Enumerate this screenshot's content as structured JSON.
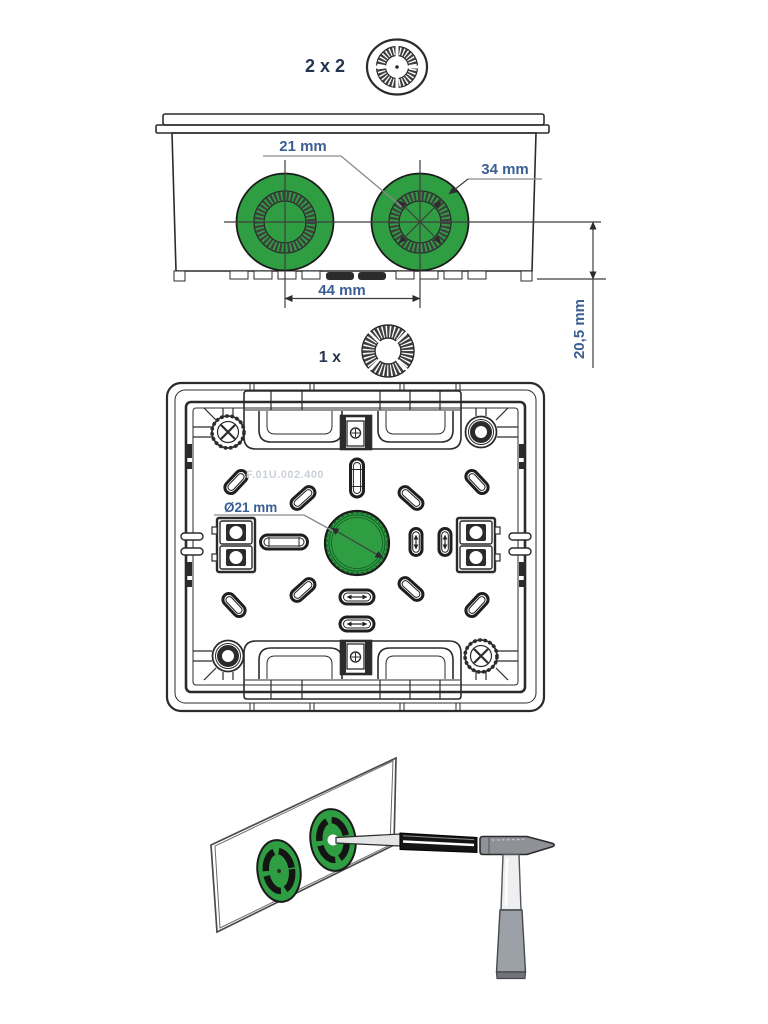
{
  "figure": {
    "colors": {
      "line": "#2b2b2b",
      "green": "#2f9e43",
      "green_dark": "#145c26",
      "dim_text": "#3a5f93",
      "qty_text": "#26354f",
      "dim_line": "#3f3f3f",
      "watermark": "#ccd1d9",
      "hammer_head": "#8e9195",
      "hammer_grip": "#9ba1a6",
      "handle_light": "#edeff0",
      "tool_dark": "#141414"
    },
    "icons": {
      "top_quantity_icon": "cable-grommet-icon",
      "middle_quantity_icon": "sealing-ring-icon"
    },
    "top_view": {
      "quantity_label": "2 x 2",
      "dim_knockout_inner": "21 mm",
      "dim_knockout_outer": "34 mm",
      "dim_center_spacing": "44 mm",
      "dim_center_height": "20,5 mm"
    },
    "back_view": {
      "quantity_label": "1 x",
      "dim_center_knockout": "Ø21 mm",
      "watermark": "F.01U.002.400"
    }
  }
}
